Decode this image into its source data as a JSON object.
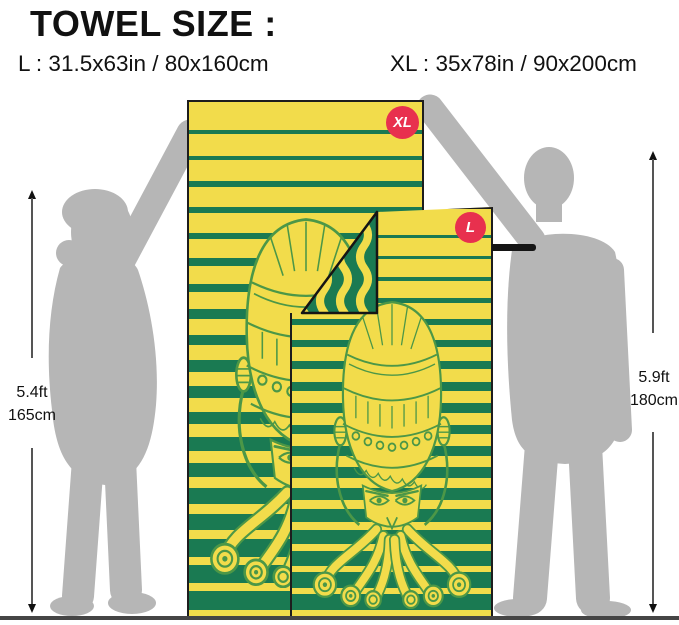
{
  "header": {
    "title": "TOWEL SIZE :",
    "size_l": "L : 31.5x63in / 80x160cm",
    "size_xl": "XL : 35x78in / 90x200cm"
  },
  "badges": {
    "xl": "XL",
    "l": "L"
  },
  "measurements": {
    "left": {
      "ft": "5.4ft",
      "cm": "165cm"
    },
    "right": {
      "ft": "5.9ft",
      "cm": "180cm"
    }
  },
  "colors": {
    "towel_yellow": "#F2DC4B",
    "stripe_green": "#1A7A52",
    "octo_green": "#4C9747",
    "badge_red": "#E8304E",
    "silhouette_gray": "#B6B6B6",
    "ink": "#111111",
    "ground": "#454545",
    "arrow": "#555555"
  }
}
